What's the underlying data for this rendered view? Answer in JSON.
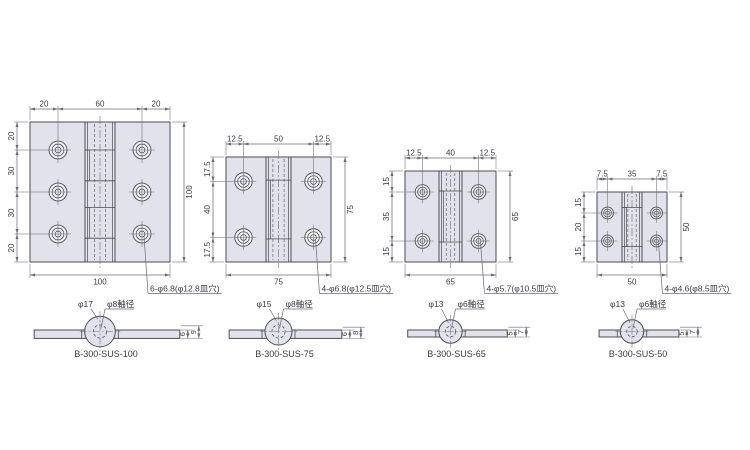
{
  "colors": {
    "background": "#ffffff",
    "body_fill": "#e1e2eb",
    "hole_fill": "#f2f3f7",
    "outline": "#4d4d55",
    "dim_line": "#6b6b74",
    "text": "#3a3a42"
  },
  "hinges": [
    {
      "name": "B-300-SUS-100",
      "plan": {
        "size_mm": 100,
        "top_dims": [
          "20",
          "60",
          "20"
        ],
        "left_dims": [
          "20",
          "30",
          "30",
          "20"
        ],
        "width_label": "100",
        "height_label": "100",
        "hole_columns_mm": [
          20,
          80
        ],
        "hole_rows_mm": [
          20,
          50,
          80
        ],
        "countersink_dia_mm": 12.8,
        "hole_dia_mm": 6.8,
        "knuckle_count": 5,
        "hole_callout": "6-φ6.8(φ12.8皿穴)"
      },
      "side": {
        "knuckle_label": "φ17",
        "knuckle_dia_mm": 17,
        "shaft_label": "φ8軸径",
        "shaft_dia_mm": 8,
        "thickness_label": "6",
        "thickness_mm": 6,
        "overall_label": "9",
        "overall_mm": 9,
        "part_no": "B-300-SUS-100"
      }
    },
    {
      "name": "B-300-SUS-75",
      "plan": {
        "size_mm": 75,
        "top_dims": [
          "12.5",
          "50",
          "12.5"
        ],
        "left_dims": [
          "17.5",
          "40",
          "17.5"
        ],
        "width_label": "75",
        "height_label": "75",
        "hole_columns_mm": [
          12.5,
          62.5
        ],
        "hole_rows_mm": [
          17.5,
          57.5
        ],
        "countersink_dia_mm": 12.5,
        "hole_dia_mm": 6.8,
        "knuckle_count": 3,
        "hole_callout": "4-φ6.8(φ12.5皿穴)"
      },
      "side": {
        "knuckle_label": "φ15",
        "knuckle_dia_mm": 15,
        "shaft_label": "φ8軸径",
        "shaft_dia_mm": 8,
        "thickness_label": "6",
        "thickness_mm": 6,
        "overall_label": "8",
        "overall_mm": 8,
        "part_no": "B-300-SUS-75"
      }
    },
    {
      "name": "B-300-SUS-65",
      "plan": {
        "size_mm": 65,
        "top_dims": [
          "12.5",
          "40",
          "12.5"
        ],
        "left_dims": [
          "15",
          "35",
          "15"
        ],
        "width_label": "65",
        "height_label": "65",
        "hole_columns_mm": [
          12.5,
          52.5
        ],
        "hole_rows_mm": [
          15,
          50
        ],
        "countersink_dia_mm": 10.5,
        "hole_dia_mm": 5.7,
        "knuckle_count": 3,
        "hole_callout": "4-φ5.7(φ10.5皿穴)"
      },
      "side": {
        "knuckle_label": "φ13",
        "knuckle_dia_mm": 13,
        "shaft_label": "φ6軸径",
        "shaft_dia_mm": 6,
        "thickness_label": "5",
        "thickness_mm": 5,
        "overall_label": "7",
        "overall_mm": 7,
        "part_no": "B-300-SUS-65"
      }
    },
    {
      "name": "B-300-SUS-50",
      "plan": {
        "size_mm": 50,
        "top_dims": [
          "7.5",
          "35",
          "7.5"
        ],
        "left_dims": [
          "15",
          "20",
          "15"
        ],
        "width_label": "50",
        "height_label": "50",
        "hole_columns_mm": [
          7.5,
          42.5
        ],
        "hole_rows_mm": [
          15,
          35
        ],
        "countersink_dia_mm": 8.5,
        "hole_dia_mm": 4.6,
        "knuckle_count": 3,
        "hole_callout": "4-φ4.6(φ8.5皿穴)"
      },
      "side": {
        "knuckle_label": "φ13",
        "knuckle_dia_mm": 13,
        "shaft_label": "φ6軸径",
        "shaft_dia_mm": 6,
        "thickness_label": "5",
        "thickness_mm": 5,
        "overall_label": "7",
        "overall_mm": 7,
        "part_no": "B-300-SUS-50"
      }
    }
  ]
}
